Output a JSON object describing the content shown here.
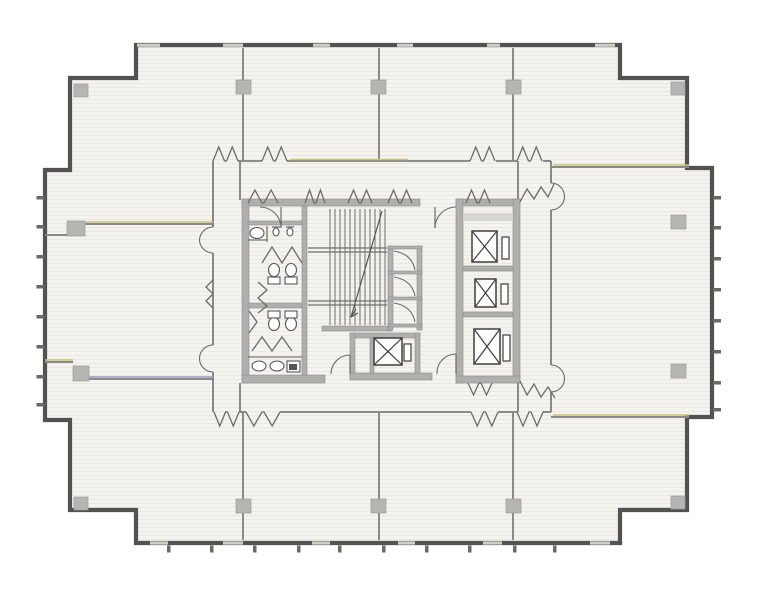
{
  "meta": {
    "kind": "architectural floor plan"
  },
  "palette": {
    "paper": "#ffffff",
    "room_fill": "#f4f3ef",
    "scanline": "#e9e9e3",
    "outer_wall": "#525252",
    "thin_wall": "#8a8a87",
    "corridor_wall": "#7c7c79",
    "core_wall": "#afafac",
    "core_wall_light": "#d6d6d2",
    "column": "#b5b5b2",
    "door": "#6b6b68",
    "fixture": "#585856",
    "tint_yellow": "#c9c37b",
    "tint_lavender": "#a99fcd"
  },
  "plan": {
    "outline": [
      [
        136,
        45
      ],
      [
        620,
        45
      ],
      [
        620,
        78
      ],
      [
        687,
        78
      ],
      [
        687,
        168
      ],
      [
        712,
        168
      ],
      [
        712,
        417
      ],
      [
        687,
        417
      ],
      [
        687,
        510
      ],
      [
        620,
        510
      ],
      [
        620,
        543
      ],
      [
        136,
        543
      ],
      [
        136,
        510
      ],
      [
        70,
        510
      ],
      [
        70,
        420
      ],
      [
        45,
        420
      ],
      [
        45,
        170
      ],
      [
        70,
        170
      ],
      [
        70,
        78
      ],
      [
        136,
        78
      ]
    ],
    "breaks_top": [
      [
        137,
        160
      ],
      [
        223,
        243
      ],
      [
        313,
        330
      ],
      [
        397,
        413
      ],
      [
        487,
        500
      ],
      [
        595,
        615
      ]
    ],
    "breaks_bottom": [
      [
        150,
        168
      ],
      [
        223,
        243
      ],
      [
        312,
        330
      ],
      [
        398,
        415
      ],
      [
        483,
        502
      ],
      [
        590,
        610
      ]
    ],
    "ticks_left_y": [
      196,
      225,
      255,
      285,
      315,
      345,
      375,
      403
    ],
    "ticks_right_y": [
      196,
      226,
      257,
      288,
      319,
      350,
      381,
      408
    ],
    "ticks_bottom_x": [
      167,
      210,
      253,
      297,
      338,
      382,
      425,
      468,
      513,
      553
    ],
    "columns": [
      [
        236,
        80,
        15,
        14
      ],
      [
        371,
        80,
        15,
        14
      ],
      [
        506,
        80,
        15,
        14
      ],
      [
        74,
        84,
        14,
        13
      ],
      [
        671,
        82,
        14,
        13
      ],
      [
        236,
        499,
        15,
        14
      ],
      [
        371,
        499,
        15,
        14
      ],
      [
        506,
        499,
        15,
        14
      ],
      [
        74,
        497,
        14,
        13
      ],
      [
        671,
        496,
        14,
        13
      ],
      [
        67,
        221,
        18,
        15
      ],
      [
        73,
        366,
        16,
        15
      ],
      [
        671,
        215,
        15,
        14
      ],
      [
        671,
        364,
        15,
        14
      ]
    ],
    "thin_walls": [
      [
        243,
        48,
        243,
        160
      ],
      [
        379,
        48,
        379,
        160
      ],
      [
        513,
        48,
        513,
        160
      ],
      [
        243,
        413,
        243,
        540
      ],
      [
        379,
        413,
        379,
        540
      ],
      [
        513,
        413,
        513,
        540
      ],
      [
        45,
        235,
        67,
        235
      ],
      [
        85,
        224,
        213,
        224
      ],
      [
        45,
        362,
        73,
        362
      ],
      [
        89,
        379,
        213,
        379
      ],
      [
        551,
        167,
        689,
        167
      ],
      [
        551,
        417,
        689,
        417
      ],
      [
        551,
        161,
        551,
        168
      ],
      [
        240,
        161,
        240,
        200
      ],
      [
        518,
        161,
        518,
        200
      ],
      [
        240,
        383,
        240,
        412
      ],
      [
        518,
        383,
        518,
        412
      ]
    ],
    "corridor_walls": [
      [
        238,
        161,
        262,
        161
      ],
      [
        287,
        161,
        470,
        161
      ],
      [
        496,
        161,
        517,
        161
      ],
      [
        543,
        161,
        551,
        161
      ],
      [
        239,
        412,
        246,
        412
      ],
      [
        280,
        412,
        471,
        412
      ],
      [
        498,
        412,
        517,
        412
      ],
      [
        543,
        412,
        551,
        412
      ],
      [
        213,
        161,
        213,
        227
      ],
      [
        213,
        253,
        213,
        345
      ],
      [
        213,
        372,
        213,
        412
      ],
      [
        551,
        168,
        551,
        183
      ],
      [
        551,
        210,
        551,
        365
      ],
      [
        551,
        392,
        551,
        412
      ]
    ],
    "tint_yellow_lines": [
      [
        85,
        222,
        213,
        222
      ],
      [
        45,
        360,
        73,
        360
      ],
      [
        290,
        159.5,
        408,
        159.5
      ],
      [
        553,
        165,
        689,
        165
      ],
      [
        553,
        415,
        689,
        415
      ]
    ],
    "tint_lavender_lines": [
      [
        89,
        377,
        213,
        377
      ]
    ],
    "core_walls": [
      [
        242,
        199,
        178,
        7
      ],
      [
        456,
        199,
        64,
        7
      ],
      [
        242,
        199,
        7,
        184
      ],
      [
        242,
        375,
        83,
        8
      ],
      [
        302,
        206,
        5,
        169
      ],
      [
        248,
        221,
        54,
        4
      ],
      [
        248,
        303,
        54,
        5
      ],
      [
        322,
        326,
        70,
        5
      ],
      [
        350,
        333,
        70,
        5
      ],
      [
        350,
        333,
        5,
        46
      ],
      [
        415,
        333,
        5,
        46
      ],
      [
        350,
        373,
        82,
        7
      ],
      [
        370,
        338,
        4,
        35
      ],
      [
        388,
        246,
        5,
        84
      ],
      [
        417,
        246,
        5,
        84
      ],
      [
        388,
        246,
        34,
        3
      ],
      [
        388,
        271,
        34,
        3
      ],
      [
        388,
        297,
        34,
        3
      ],
      [
        388,
        324,
        34,
        3
      ],
      [
        456,
        199,
        7,
        184
      ],
      [
        513,
        199,
        7,
        184
      ],
      [
        456,
        376,
        64,
        7
      ],
      [
        463,
        266,
        50,
        5
      ],
      [
        463,
        312,
        50,
        5
      ]
    ],
    "core_walls_light": [
      [
        463,
        213,
        50,
        8
      ]
    ],
    "stair": {
      "tread_x": [
        330,
        335,
        340,
        345,
        350,
        355,
        360,
        365,
        370,
        375,
        380,
        385
      ],
      "tread_y1": 209,
      "tread_y2": 325,
      "landings": [
        [
          308,
          248,
          387,
          248
        ],
        [
          308,
          252,
          387,
          252
        ],
        [
          308,
          301,
          387,
          301
        ],
        [
          308,
          305,
          387,
          305
        ]
      ],
      "diagonal": [
        382,
        211,
        351,
        317
      ],
      "arrow": [
        [
          351,
          317,
          356,
          309
        ],
        [
          351,
          317,
          358,
          313
        ]
      ]
    },
    "closet_flaps": [
      [
        393,
        249
      ],
      [
        393,
        275
      ],
      [
        393,
        301
      ]
    ],
    "elevators": [
      {
        "box": [
          374,
          338,
          28,
          27
        ],
        "slot": [
          404,
          344,
          7,
          17
        ]
      },
      {
        "box": [
          472,
          231,
          25,
          31
        ],
        "slot": [
          502,
          237,
          7,
          22
        ]
      },
      {
        "box": [
          475,
          279,
          21,
          28
        ],
        "slot": [
          501,
          284,
          7,
          20
        ]
      },
      {
        "box": [
          474,
          329,
          26,
          35
        ],
        "slot": [
          503,
          335,
          7,
          26
        ]
      }
    ],
    "double_doors_top": {
      "y": 161,
      "dir": -1,
      "amp": 14,
      "openings": [
        [
          213,
          238
        ],
        [
          262,
          287
        ],
        [
          470,
          495
        ],
        [
          517,
          542
        ]
      ]
    },
    "double_doors_bottom": {
      "y": 412,
      "dir": 1,
      "amp": 14,
      "openings": [
        [
          214,
          239
        ],
        [
          246,
          280
        ],
        [
          471,
          498
        ],
        [
          517,
          543
        ]
      ]
    },
    "accordion_core_top": {
      "y": 203,
      "dir": -1,
      "amp": 13,
      "openings": [
        [
          248,
          278
        ],
        [
          305,
          325
        ],
        [
          348,
          372
        ],
        [
          388,
          412
        ],
        [
          466,
          490
        ]
      ]
    },
    "accordion_core_bottom": {
      "y": 383,
      "dir": 1,
      "amp": 12,
      "openings": [
        [
          468,
          492
        ]
      ]
    },
    "zigzags": [
      [
        [
          258,
          282
        ],
        [
          267,
          290
        ],
        [
          258,
          298
        ],
        [
          267,
          306
        ],
        [
          258,
          313
        ]
      ],
      [
        [
          213,
          280
        ],
        [
          206,
          287
        ],
        [
          213,
          294
        ],
        [
          206,
          301
        ],
        [
          213,
          308
        ]
      ],
      [
        [
          520,
          202
        ],
        [
          527,
          189
        ],
        [
          534,
          199
        ],
        [
          541,
          187
        ],
        [
          548,
          197
        ],
        [
          554,
          184
        ]
      ],
      [
        [
          520,
          381
        ],
        [
          527,
          395
        ],
        [
          534,
          384
        ],
        [
          541,
          397
        ],
        [
          548,
          387
        ],
        [
          555,
          398
        ]
      ],
      [
        [
          262,
          263
        ],
        [
          272,
          247
        ],
        [
          282,
          263
        ],
        [
          292,
          247
        ],
        [
          302,
          263
        ]
      ],
      [
        [
          252,
          351
        ],
        [
          262,
          337
        ],
        [
          272,
          351
        ],
        [
          282,
          337
        ],
        [
          292,
          351
        ]
      ],
      [
        [
          249,
          311
        ],
        [
          257,
          322
        ],
        [
          249,
          333
        ]
      ]
    ],
    "swing_leaves": [
      [
        435,
        207,
        435,
        228
      ],
      [
        350,
        355,
        350,
        374
      ],
      [
        456,
        354,
        456,
        374
      ],
      [
        281,
        207,
        281,
        228
      ]
    ],
    "swing_arcs": [
      "M 435,228 A 21,21 0 0 1 456,207",
      "M 350,355 A 19,19 0 0 0 331,374",
      "M 456,354 A 19,19 0 0 0 437,374",
      "M 281,228 A 21,21 0 0 0 260,207",
      "M 213,227 A 13.5,13.5 0 0 0 199.5,240.5",
      "M 213,253 A 13.5,13.5 0 0 1 199.5,240.5",
      "M 213,345 A 13.5,13.5 0 0 0 199.5,358.5",
      "M 213,372 A 13.5,13.5 0 0 1 199.5,358.5",
      "M 551,183 A 13.5,13.5 0 0 1 564.5,196.5",
      "M 551,210 A 13.5,13.5 0 0 0 564.5,196.5",
      "M 551,365 A 13.5,13.5 0 0 1 564.5,378.5",
      "M 551,392 A 13.5,13.5 0 0 0 564.5,378.5"
    ],
    "fixtures": {
      "ellipses": [
        [
          257,
          233,
          7,
          5.5
        ],
        [
          276,
          232,
          3,
          4
        ],
        [
          290,
          232,
          3,
          4
        ],
        [
          274,
          270,
          5.5,
          6.5
        ],
        [
          291,
          270,
          5.5,
          6.5
        ],
        [
          274,
          324,
          5.5,
          6.5
        ],
        [
          291,
          324,
          5.5,
          6.5
        ],
        [
          259,
          366,
          7,
          5
        ],
        [
          277,
          366,
          7,
          5
        ]
      ],
      "rects": [
        [
          268,
          277,
          12,
          7
        ],
        [
          285,
          277,
          12,
          7
        ],
        [
          268,
          311,
          12,
          7
        ],
        [
          285,
          311,
          12,
          7
        ],
        [
          287,
          361,
          13,
          11
        ]
      ],
      "dark_rects": [
        [
          289,
          364,
          8,
          6
        ]
      ],
      "lines": [
        [
          267,
          226,
          267,
          242
        ],
        [
          248,
          240,
          267,
          240
        ],
        [
          272,
          227,
          280,
          227
        ],
        [
          286,
          227,
          294,
          227
        ],
        [
          248,
          357,
          302,
          357
        ]
      ]
    }
  }
}
